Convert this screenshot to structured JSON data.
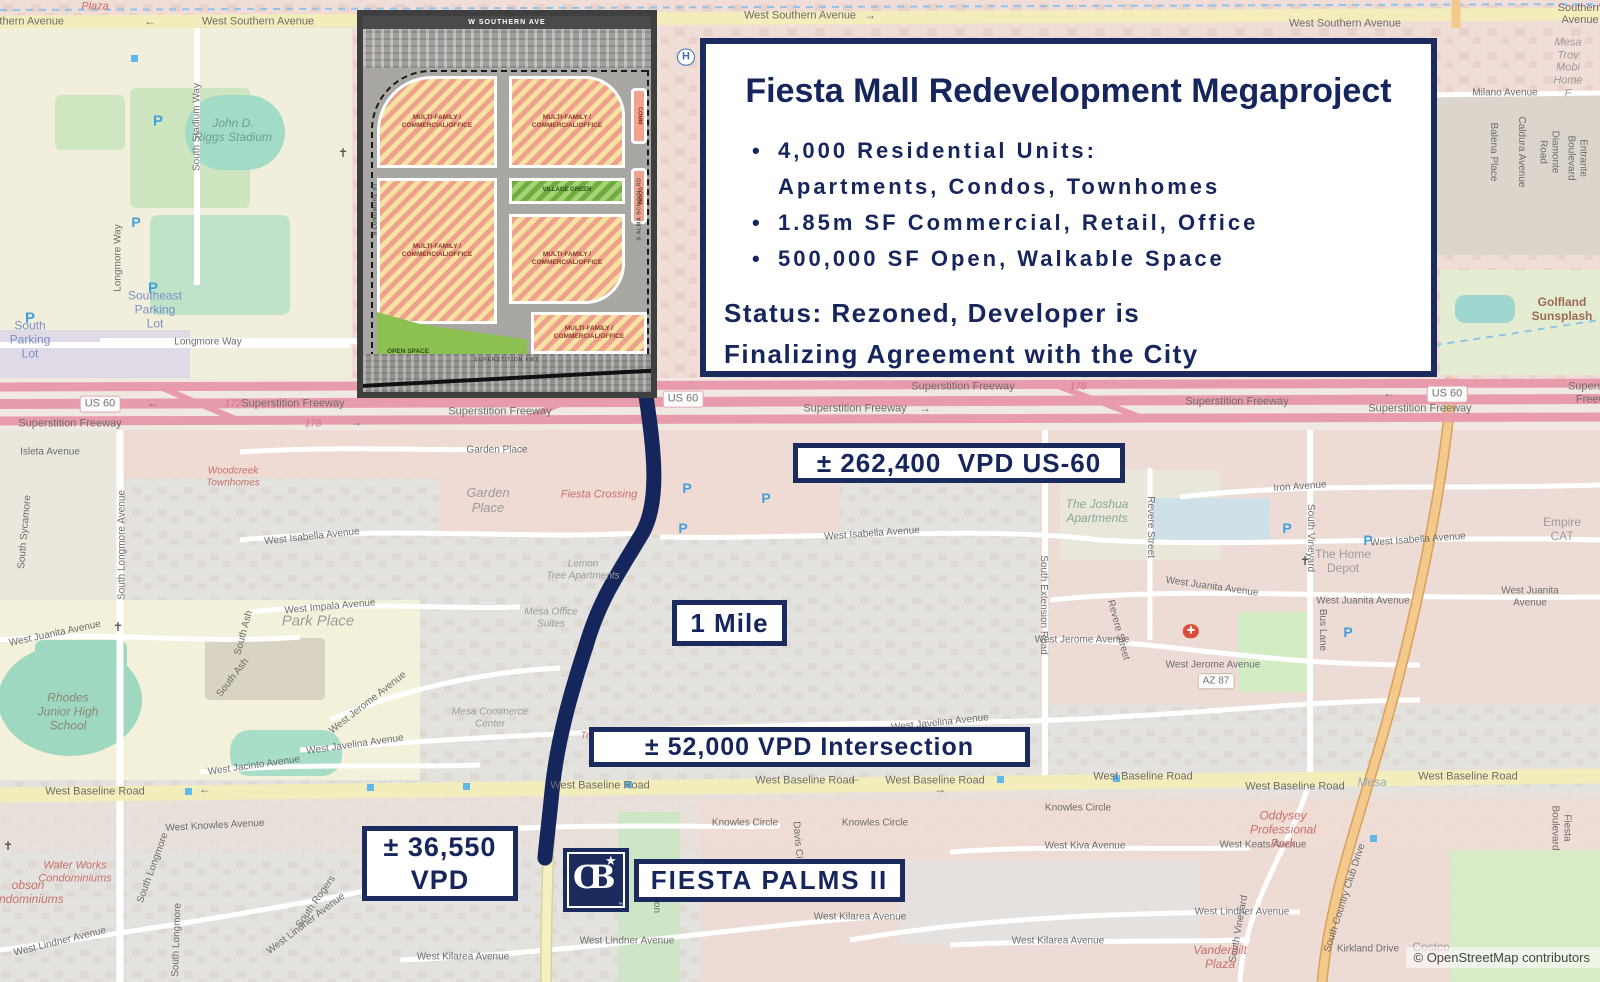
{
  "colors": {
    "navy": "#1b2b5e",
    "route": "#15265c",
    "freeway_pink": "#e89cab",
    "road_yellow": "#f2edbb",
    "map_gray": "#e4e2df"
  },
  "info_box": {
    "title": "Fiesta Mall Redevelopment Megaproject",
    "bullet1_line1": "4,000 Residential Units:",
    "bullet1_line2": "Apartments, Condos, Townhomes",
    "bullet2": "1.85m SF Commercial, Retail, Office",
    "bullet3": "500,000 SF Open, Walkable Space",
    "status_line1": "Status: Rezoned, Developer is",
    "status_line2": "Finalizing Agreement with the City"
  },
  "labels": {
    "us60_vpd": "± 262,400  VPD US-60",
    "one_mile": "1 Mile",
    "intersection_vpd": "± 52,000 VPD Intersection",
    "vpd36_line1": "± 36,550",
    "vpd36_line2": "VPD",
    "site_name": "FIESTA PALMS II"
  },
  "logo": {
    "text": "CB",
    "star": "★",
    "tm": "™"
  },
  "inset": {
    "top_road": "W SOUTHERN AVE",
    "left_road": "S LONGMORE ST",
    "right_road": "S ALMA SCHOOL RD",
    "bottom_road": "SUPERSTITION FWY",
    "multi_label": "MULTI-FAMILY /\nCOMMERCIAL/OFFICE",
    "village_label": "VILLAGE GREEN",
    "open_label": "OPEN SPACE",
    "comm_label": "COMM"
  },
  "map": {
    "attribution": "© OpenStreetMap contributors",
    "labels": [
      {
        "t": "Plaza",
        "x": 95,
        "y": 7,
        "s": 11,
        "c": "#c9706d",
        "i": 1
      },
      {
        "t": "West Southern Avenue",
        "x": 8,
        "y": 22,
        "s": 11
      },
      {
        "t": "West Southern Avenue",
        "x": 258,
        "y": 22,
        "s": 11
      },
      {
        "t": "West Southern Avenue",
        "x": 800,
        "y": 16,
        "s": 11
      },
      {
        "t": "West Southern Avenue",
        "x": 1345,
        "y": 24,
        "s": 11
      },
      {
        "t": "West Southern Avenue",
        "x": 1580,
        "y": 8,
        "s": 11
      },
      {
        "t": "←",
        "x": 150,
        "y": 22,
        "s": 12
      },
      {
        "t": "→",
        "x": 870,
        "y": 16,
        "s": 12
      },
      {
        "t": "Mesa Trov\nMobi\nHome F",
        "x": 1568,
        "y": 68,
        "s": 11,
        "c": "#9c9c9c",
        "i": 1
      },
      {
        "t": "Milano Avenue",
        "x": 1505,
        "y": 93,
        "s": 10
      },
      {
        "t": "Balena Place",
        "x": 1493,
        "y": 152,
        "s": 10,
        "r": 90
      },
      {
        "t": "Caldura Avenue",
        "x": 1521,
        "y": 152,
        "s": 10,
        "r": 90
      },
      {
        "t": "Diamonte Road",
        "x": 1549,
        "y": 152,
        "s": 10,
        "r": 90
      },
      {
        "t": "Entrante Boulevard",
        "x": 1577,
        "y": 158,
        "s": 10,
        "r": 90
      },
      {
        "t": "John D.\nRiggs Stadium",
        "x": 233,
        "y": 131,
        "s": 12,
        "c": "#6f9f8f",
        "i": 1
      },
      {
        "t": "South Stadium Way",
        "x": 197,
        "y": 127,
        "s": 10,
        "r": -90
      },
      {
        "t": "Longmore Way",
        "x": 118,
        "y": 258,
        "s": 10,
        "r": -90
      },
      {
        "t": "Longmore Way",
        "x": 208,
        "y": 342,
        "s": 10
      },
      {
        "t": "Southeast\nParking\nLot",
        "x": 155,
        "y": 310,
        "s": 12,
        "c": "#7b8fc9"
      },
      {
        "t": "South\nParking\nLot",
        "x": 30,
        "y": 340,
        "s": 12,
        "c": "#7b8fc9"
      },
      {
        "t": "Golfland\nSunsplash",
        "x": 1562,
        "y": 310,
        "s": 12,
        "c": "#9c6b55",
        "b": 1
      },
      {
        "t": "P",
        "x": 158,
        "y": 121,
        "s": 15,
        "c": "#41a0dc",
        "b": 1
      },
      {
        "t": "P",
        "x": 136,
        "y": 222,
        "s": 14,
        "c": "#41a0dc",
        "b": 1
      },
      {
        "t": "P",
        "x": 153,
        "y": 288,
        "s": 15,
        "c": "#41a0dc",
        "b": 1
      },
      {
        "t": "P",
        "x": 30,
        "y": 318,
        "s": 15,
        "c": "#41a0dc",
        "b": 1
      },
      {
        "t": "P",
        "x": 1186,
        "y": 230,
        "s": 14,
        "c": "#41a0dc",
        "b": 1
      },
      {
        "t": "P",
        "x": 687,
        "y": 488,
        "s": 14,
        "c": "#41a0dc",
        "b": 1
      },
      {
        "t": "P",
        "x": 766,
        "y": 498,
        "s": 14,
        "c": "#41a0dc",
        "b": 1
      },
      {
        "t": "P",
        "x": 683,
        "y": 528,
        "s": 14,
        "c": "#41a0dc",
        "b": 1
      },
      {
        "t": "P",
        "x": 1287,
        "y": 528,
        "s": 14,
        "c": "#41a0dc",
        "b": 1
      },
      {
        "t": "P",
        "x": 1368,
        "y": 540,
        "s": 14,
        "c": "#41a0dc",
        "b": 1
      },
      {
        "t": "P",
        "x": 1348,
        "y": 632,
        "s": 14,
        "c": "#41a0dc",
        "b": 1
      },
      {
        "t": "US 60",
        "x": 100,
        "y": 404,
        "s": 11,
        "c": "#77707a",
        "bg": "#fdfdfb",
        "bd": "#e0a9b4",
        "rd": 3
      },
      {
        "t": "Superstition Freeway",
        "x": 70,
        "y": 424,
        "s": 11
      },
      {
        "t": "172",
        "x": 233,
        "y": 404,
        "s": 10,
        "c": "#d66f8d",
        "i": 1
      },
      {
        "t": "Superstition Freeway",
        "x": 293,
        "y": 404,
        "s": 11
      },
      {
        "t": "178",
        "x": 313,
        "y": 424,
        "s": 10,
        "c": "#d66f8d",
        "i": 1
      },
      {
        "t": "Superstition Freeway",
        "x": 500,
        "y": 412,
        "s": 11
      },
      {
        "t": "US 60",
        "x": 683,
        "y": 399,
        "s": 11,
        "c": "#77707a",
        "bg": "#fdfdfb",
        "bd": "#e0a9b4",
        "rd": 3
      },
      {
        "t": "Superstition Freeway",
        "x": 855,
        "y": 409,
        "s": 11
      },
      {
        "t": "Superstition Freeway",
        "x": 963,
        "y": 387,
        "s": 11
      },
      {
        "t": "178",
        "x": 1078,
        "y": 387,
        "s": 10,
        "c": "#d66f8d",
        "i": 1
      },
      {
        "t": "Superstition Freeway",
        "x": 1237,
        "y": 402,
        "s": 11
      },
      {
        "t": "US 60",
        "x": 1447,
        "y": 394,
        "s": 11,
        "c": "#77707a",
        "bg": "#fdfdfb",
        "bd": "#e0a9b4",
        "rd": 3
      },
      {
        "t": "Superstition Freeway",
        "x": 1420,
        "y": 409,
        "s": 11
      },
      {
        "t": "Superstition Freeway",
        "x": 1597,
        "y": 393,
        "s": 11
      },
      {
        "t": "←",
        "x": 153,
        "y": 404,
        "s": 12
      },
      {
        "t": "→",
        "x": 356,
        "y": 423,
        "s": 12
      },
      {
        "t": "→",
        "x": 925,
        "y": 409,
        "s": 12
      },
      {
        "t": "←",
        "x": 1389,
        "y": 394,
        "s": 12
      },
      {
        "t": "H",
        "x": 686,
        "y": 57,
        "s": 11,
        "c": "#3f6fb5",
        "b": 1,
        "bg": "#fff",
        "bd": "#3f6fb5",
        "rd": 9
      },
      {
        "t": "Garden Place",
        "x": 497,
        "y": 450,
        "s": 10
      },
      {
        "t": "Garden\nPlace",
        "x": 488,
        "y": 501,
        "s": 13,
        "c": "#9c9c9c",
        "i": 1
      },
      {
        "t": "Fiesta Crossing",
        "x": 599,
        "y": 495,
        "s": 11,
        "c": "#c9706d",
        "i": 1
      },
      {
        "t": "Woodcreek\nTownhomes",
        "x": 233,
        "y": 477,
        "s": 10,
        "c": "#c9706d",
        "i": 1
      },
      {
        "t": "Isleta Avenue",
        "x": 50,
        "y": 452,
        "s": 10
      },
      {
        "t": "South Sycamore",
        "x": 25,
        "y": 532,
        "s": 10,
        "r": -85
      },
      {
        "t": "South Longmore Avenue",
        "x": 122,
        "y": 545,
        "s": 10,
        "r": -90
      },
      {
        "t": "South Ash",
        "x": 244,
        "y": 633,
        "s": 10,
        "r": -75
      },
      {
        "t": "South Ash",
        "x": 233,
        "y": 678,
        "s": 10,
        "r": -52
      },
      {
        "t": "West Isabella Avenue",
        "x": 312,
        "y": 537,
        "s": 10,
        "r": -6
      },
      {
        "t": "West Isabella Avenue",
        "x": 872,
        "y": 534,
        "s": 10,
        "r": -4
      },
      {
        "t": "West Isabella Avenue",
        "x": 1418,
        "y": 540,
        "s": 10,
        "r": -4
      },
      {
        "t": "Lemon\nTree Apartments",
        "x": 583,
        "y": 570,
        "s": 10,
        "c": "#9c9c9c",
        "i": 1
      },
      {
        "t": "Mesa Office\nSuites",
        "x": 551,
        "y": 618,
        "s": 10,
        "c": "#9c9c9c",
        "i": 1
      },
      {
        "t": "Mesa Commerce\nCenter",
        "x": 490,
        "y": 718,
        "s": 10,
        "c": "#9c9c9c",
        "i": 1
      },
      {
        "t": "Park Place",
        "x": 318,
        "y": 621,
        "s": 15,
        "c": "#9c9c9c",
        "i": 1
      },
      {
        "t": "West Impala Avenue",
        "x": 330,
        "y": 607,
        "s": 10,
        "r": -5
      },
      {
        "t": "West Juanita Avenue",
        "x": 55,
        "y": 634,
        "s": 10,
        "r": -12
      },
      {
        "t": "West Juanita Avenue",
        "x": 1212,
        "y": 587,
        "s": 10,
        "r": 8
      },
      {
        "t": "West Juanita Avenue",
        "x": 1363,
        "y": 601,
        "s": 10
      },
      {
        "t": "West Juanita Avenue",
        "x": 1530,
        "y": 597,
        "s": 10
      },
      {
        "t": "West Jerome Avenue",
        "x": 368,
        "y": 703,
        "s": 10,
        "r": -38
      },
      {
        "t": "West Jerome Avenue",
        "x": 1082,
        "y": 640,
        "s": 10
      },
      {
        "t": "West Jerome Avenue",
        "x": 1213,
        "y": 665,
        "s": 10
      },
      {
        "t": "West Javelina Avenue",
        "x": 355,
        "y": 745,
        "s": 10,
        "r": -8
      },
      {
        "t": "West Javelina Avenue",
        "x": 940,
        "y": 723,
        "s": 10,
        "r": -6
      },
      {
        "t": "West Jacinto Avenue",
        "x": 254,
        "y": 766,
        "s": 10,
        "r": -8
      },
      {
        "t": "Rhodes\nJunior High\nSchool",
        "x": 68,
        "y": 712,
        "s": 12,
        "c": "#8c8672",
        "i": 1
      },
      {
        "t": "Trailside",
        "x": 599,
        "y": 736,
        "s": 10,
        "c": "#c9706d",
        "i": 1
      },
      {
        "t": "The Joshua\nApartments",
        "x": 1097,
        "y": 512,
        "s": 12,
        "c": "#8aa69b",
        "i": 1
      },
      {
        "t": "Iron Avenue",
        "x": 1300,
        "y": 487,
        "s": 10,
        "r": -4
      },
      {
        "t": "Revere Street",
        "x": 1150,
        "y": 527,
        "s": 10,
        "r": 90
      },
      {
        "t": "Revere Street",
        "x": 1118,
        "y": 630,
        "s": 10,
        "r": 75
      },
      {
        "t": "South Extension Road",
        "x": 1043,
        "y": 605,
        "s": 10,
        "r": 90
      },
      {
        "t": "South Vineyard",
        "x": 1310,
        "y": 538,
        "s": 10,
        "r": 90
      },
      {
        "t": "Bus Lane",
        "x": 1322,
        "y": 630,
        "s": 10,
        "r": 90
      },
      {
        "t": "The Home\nDepot",
        "x": 1343,
        "y": 562,
        "s": 12,
        "c": "#9c9c9c"
      },
      {
        "t": "Empire\nCAT",
        "x": 1562,
        "y": 530,
        "s": 12,
        "c": "#9c9c9c"
      },
      {
        "t": "AZ 87",
        "x": 1216,
        "y": 681,
        "s": 10,
        "c": "#77707a",
        "bg": "#fdfdfb",
        "bd": "#cbb7a0",
        "rd": 3
      },
      {
        "t": "✚",
        "x": 1191,
        "y": 631,
        "s": 10,
        "c": "#fff",
        "bg": "#dd4b39",
        "rd": 8
      },
      {
        "t": "✝",
        "x": 343,
        "y": 154,
        "s": 12,
        "c": "#555"
      },
      {
        "t": "✝",
        "x": 1305,
        "y": 562,
        "s": 12,
        "c": "#555"
      },
      {
        "t": "✝",
        "x": 8,
        "y": 847,
        "s": 12,
        "c": "#555"
      },
      {
        "t": "✝",
        "x": 118,
        "y": 628,
        "s": 12,
        "c": "#555"
      },
      {
        "t": "West Baseline Road",
        "x": 95,
        "y": 792,
        "s": 11
      },
      {
        "t": "West Baseline Road",
        "x": 600,
        "y": 786,
        "s": 11
      },
      {
        "t": "West Baseline Road",
        "x": 805,
        "y": 781,
        "s": 11
      },
      {
        "t": "West Baseline Road",
        "x": 935,
        "y": 781,
        "s": 11
      },
      {
        "t": "West Baseline Road",
        "x": 1143,
        "y": 777,
        "s": 11
      },
      {
        "t": "West Baseline Road",
        "x": 1295,
        "y": 787,
        "s": 11
      },
      {
        "t": "West Baseline Road",
        "x": 1468,
        "y": 777,
        "s": 11
      },
      {
        "t": "←",
        "x": 205,
        "y": 790,
        "s": 12
      },
      {
        "t": "←",
        "x": 855,
        "y": 779,
        "s": 12
      },
      {
        "t": "→",
        "x": 940,
        "y": 790,
        "s": 12
      },
      {
        "t": "West Knowles Avenue",
        "x": 215,
        "y": 826,
        "s": 10,
        "r": -3
      },
      {
        "t": "Knowles Circle",
        "x": 745,
        "y": 823,
        "s": 10
      },
      {
        "t": "Knowles Circle",
        "x": 875,
        "y": 823,
        "s": 10
      },
      {
        "t": "Knowles Circle",
        "x": 1078,
        "y": 808,
        "s": 10
      },
      {
        "t": "West Keats Avenue",
        "x": 1263,
        "y": 845,
        "s": 10
      },
      {
        "t": "Davis Circle",
        "x": 798,
        "y": 848,
        "s": 10,
        "r": 85
      },
      {
        "t": "Emerson",
        "x": 656,
        "y": 893,
        "s": 10,
        "r": 90
      },
      {
        "t": "Waterford",
        "x": 664,
        "y": 866,
        "s": 10,
        "c": "#9aa39a",
        "i": 1
      },
      {
        "t": "West Kiva Avenue",
        "x": 1085,
        "y": 846,
        "s": 10
      },
      {
        "t": "obson\nondominiums",
        "x": 28,
        "y": 893,
        "s": 12,
        "c": "#c9706d",
        "i": 1
      },
      {
        "t": "Water Works\nCondominiums",
        "x": 75,
        "y": 872,
        "s": 11,
        "c": "#c9706d",
        "i": 1
      },
      {
        "t": "West Lindner Avenue",
        "x": 60,
        "y": 942,
        "s": 10,
        "r": -14
      },
      {
        "t": "West Lindner Avenue",
        "x": 306,
        "y": 924,
        "s": 10,
        "r": -37
      },
      {
        "t": "West Lindner Avenue",
        "x": 627,
        "y": 941,
        "s": 10
      },
      {
        "t": "West Lindner Avenue",
        "x": 1242,
        "y": 912,
        "s": 10
      },
      {
        "t": "West Kilarea Avenue",
        "x": 463,
        "y": 957,
        "s": 10
      },
      {
        "t": "West Kilarea Avenue",
        "x": 860,
        "y": 917,
        "s": 10
      },
      {
        "t": "West Kilarea Avenue",
        "x": 1058,
        "y": 941,
        "s": 10
      },
      {
        "t": "South Rogers",
        "x": 316,
        "y": 902,
        "s": 10,
        "r": -55
      },
      {
        "t": "South Longmore",
        "x": 153,
        "y": 868,
        "s": 10,
        "r": -70
      },
      {
        "t": "South Longmore",
        "x": 177,
        "y": 940,
        "s": 10,
        "r": -88
      },
      {
        "t": "South Country Club Drive",
        "x": 1345,
        "y": 898,
        "s": 10,
        "r": -72
      },
      {
        "t": "Kirkland Drive",
        "x": 1368,
        "y": 949,
        "s": 10
      },
      {
        "t": "Costco",
        "x": 1431,
        "y": 948,
        "s": 12,
        "c": "#9c9c9c"
      },
      {
        "t": "Oddysey\nProfessional\nPark",
        "x": 1283,
        "y": 830,
        "s": 12,
        "c": "#c9706d",
        "i": 1
      },
      {
        "t": "Vanderbilt\nPlaza",
        "x": 1220,
        "y": 958,
        "s": 12,
        "c": "#c9706d",
        "i": 1
      },
      {
        "t": "Fiesta Boulevard",
        "x": 1561,
        "y": 828,
        "s": 10,
        "r": 90
      },
      {
        "t": "South Vineyard",
        "x": 1239,
        "y": 929,
        "s": 10,
        "r": -80
      },
      {
        "t": "Mesa",
        "x": 1372,
        "y": 783,
        "s": 12,
        "c": "#93a9c4",
        "i": 1
      }
    ]
  }
}
